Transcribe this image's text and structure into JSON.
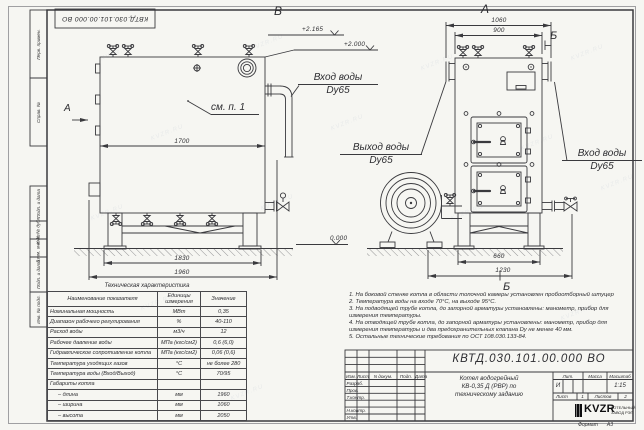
{
  "sheet": {
    "stamp_top": "КВТД.030.101.00.000  ВО",
    "format_label": "Формат",
    "format_value": "А3",
    "watermark": "KVZR.RU"
  },
  "margin_labels": [
    "Перв. примен.",
    "Справ. №",
    "Подп. и дата",
    "Инв. № дубл.",
    "Взам. инв. №",
    "Подп. и дата",
    "Инв. № подл."
  ],
  "views": {
    "left_label": "В",
    "right_label": "А",
    "section_arrow_label": "А",
    "section_b_top": "Б",
    "section_b_bottom": "Б",
    "see_note": "см. п. 1"
  },
  "annotations": {
    "inlet_left_line1": "Вход воды",
    "inlet_left_line2": "Dy65",
    "outlet_line1": "Выход воды",
    "outlet_line2": "Dy65",
    "inlet_right_line1": "Вход воды",
    "inlet_right_line2": "Dy65",
    "elev_top1": "+2.165",
    "elev_top2": "+2.000",
    "elev_zero": "0.000"
  },
  "dimensions": {
    "left_width": "1700",
    "left_base": "1830",
    "left_overall": "1960",
    "right_top_overall": "1060",
    "right_top_face": "900",
    "right_base": "660",
    "right_base_overall": "1230"
  },
  "tech_table": {
    "title": "Техническая характеристика",
    "headers": [
      "Наименование показателя",
      "Единицы измерения",
      "Значение"
    ],
    "rows": [
      {
        "name": "Номинальная мощность",
        "unit": "МВт",
        "value": "0,35"
      },
      {
        "name": "Диапазон рабочего регулирования",
        "unit": "%",
        "value": "40-110"
      },
      {
        "name": "Расход воды",
        "unit": "м3/ч",
        "value": "12"
      },
      {
        "name": "Рабочее давление воды",
        "unit": "МПа (кгс/см2)",
        "value": "0,6 (6,0)"
      },
      {
        "name": "Гидравлическое сопротивление котла",
        "unit": "МПа (кгс/см2)",
        "value": "0,06 (0,6)"
      },
      {
        "name": "Температура уходящих газов",
        "unit": "°С",
        "value": "не более 280"
      },
      {
        "name": "Температура воды (Вход/Выход)",
        "unit": "°С",
        "value": "70/95"
      },
      {
        "name": "Габариты котла",
        "unit": "",
        "value": ""
      },
      {
        "name": "– длина",
        "unit": "мм",
        "value": "1960"
      },
      {
        "name": "– ширина",
        "unit": "мм",
        "value": "1060"
      },
      {
        "name": "– высота",
        "unit": "мм",
        "value": "2050"
      }
    ]
  },
  "notes": {
    "items": [
      "1.  На боковой стенке котла в области топочной камеры установлен пробоотборный штуцер",
      "2.  Температура воды на входе 70°С, на выходе 95°С.",
      "3.  На подводящей трубе котла, до запорной арматуры установлены: манометр, прибор для измерения температуры.",
      "4.  На отводящей трубе котла, до запорной арматуры установлены: манометр, прибор для измерения температуры и два предохранительных клапана Dу не менее 40 мм.",
      "5.  Остальные технические требования по ОСТ 108.030.133-84."
    ]
  },
  "title_block": {
    "doc_number": "КВТД.030.101.00.000  ВО",
    "title_line1": "Котел водогрейный",
    "title_line2": "КВ-0,35 Д (РВР) по",
    "title_line3": "техническому заданию",
    "rev_headers": [
      "Изм.",
      "Лист",
      "N докум.",
      "Подп.",
      "Дата"
    ],
    "sign_rows": [
      "Разраб.",
      "Пров.",
      "Т.контр.",
      "",
      "Н.контр.",
      "Утв."
    ],
    "lit_header": "Лит.",
    "mass_header": "Масса",
    "scale_header": "Масштаб",
    "lit_value": "И",
    "scale_value": "1:15",
    "sheet_label": "Лист",
    "sheet_value": "1",
    "sheets_label": "Листов",
    "sheets_value": "2",
    "logo_text": "KVZR",
    "logo_caption1": "КОТЕЛЬНЫЙ",
    "logo_caption2": "ЗАВОД РЭП"
  }
}
